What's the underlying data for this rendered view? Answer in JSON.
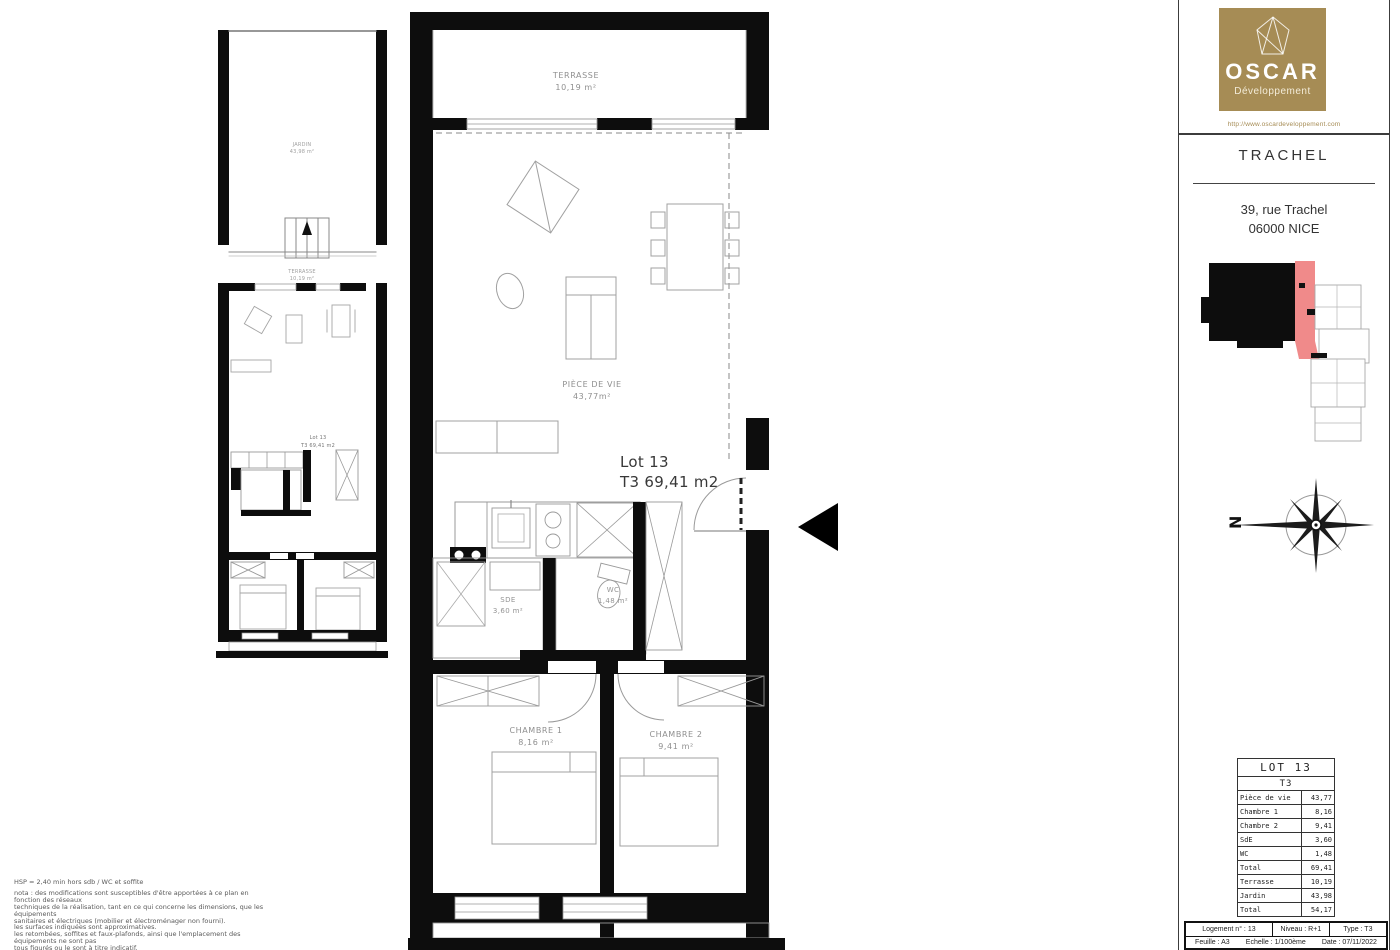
{
  "header": {
    "brand": "OSCAR",
    "brand_sub": "Développement",
    "website": "http://www.oscardeveloppement.com",
    "project": "TRACHEL",
    "address_line1": "39, rue Trachel",
    "address_line2": "06000 NICE"
  },
  "colors": {
    "brand_gold": "#A68C55",
    "lot_highlight_red": "#F08A8A",
    "wall_black": "#0D0D0D",
    "drawing_gray": "#9a9a9a"
  },
  "compass": {
    "north": "N"
  },
  "main_plan": {
    "terrasse_name": "TERRASSE",
    "terrasse_area": "10,19 m²",
    "piece_name": "PIÈCE DE VIE",
    "piece_area": "43,77m²",
    "lot": "Lot 13",
    "lot_type": "T3 69,41 m2",
    "sde_name": "SDE",
    "sde_area": "3,60 m²",
    "wc_name": "WC",
    "wc_area": "1,48 m²",
    "ch1_name": "CHAMBRE 1",
    "ch1_area": "8,16 m²",
    "ch2_name": "CHAMBRE 2",
    "ch2_area": "9,41 m²"
  },
  "small_plan": {
    "jardin_name": "JARDIN",
    "jardin_area": "43,98 m²",
    "terrasse_name": "TERRASSE",
    "terrasse_area": "10,19 m²",
    "lot": "Lot 13",
    "lot_type": "T3 69,41 m2"
  },
  "area_table": {
    "title": "LOT 13",
    "subtitle": "T3",
    "rows": [
      {
        "label": "Pièce de vie",
        "value": "43,77"
      },
      {
        "label": "Chambre 1",
        "value": "8,16"
      },
      {
        "label": "Chambre 2",
        "value": "9,41"
      },
      {
        "label": "SdE",
        "value": "3,60"
      },
      {
        "label": "WC",
        "value": "1,48"
      },
      {
        "label": "Total",
        "value": "69,41"
      },
      {
        "label": "Terrasse",
        "value": "10,19"
      },
      {
        "label": "Jardin",
        "value": "43,98"
      },
      {
        "label": "Total",
        "value": "54,17"
      }
    ]
  },
  "title_block": {
    "logement": "Logement n° : 13",
    "niveau": "Niveau : R+1",
    "type": "Type : T3",
    "feuille": "Feuille : A3",
    "echelle": "Echelle : 1/100ème",
    "date": "Date : 07/11/2022"
  },
  "notes": {
    "line0": "HSP = 2,40 min hors sdb / WC et soffite",
    "line1": "nota : des modifications sont susceptibles d'être apportées à ce plan en fonction des réseaux",
    "line2": "techniques de la réalisation, tant en ce qui concerne les dimensions, que les équipements",
    "line3": "sanitaires et électriques (mobilier et électroménager non fourni).",
    "line4": "les surfaces indiquées sont approximatives.",
    "line5": "les retombées, soffites et faux-plafonds, ainsi que l'emplacement des équipements ne sont pas",
    "line6": "tous figurés ou le sont à titre indicatif."
  }
}
